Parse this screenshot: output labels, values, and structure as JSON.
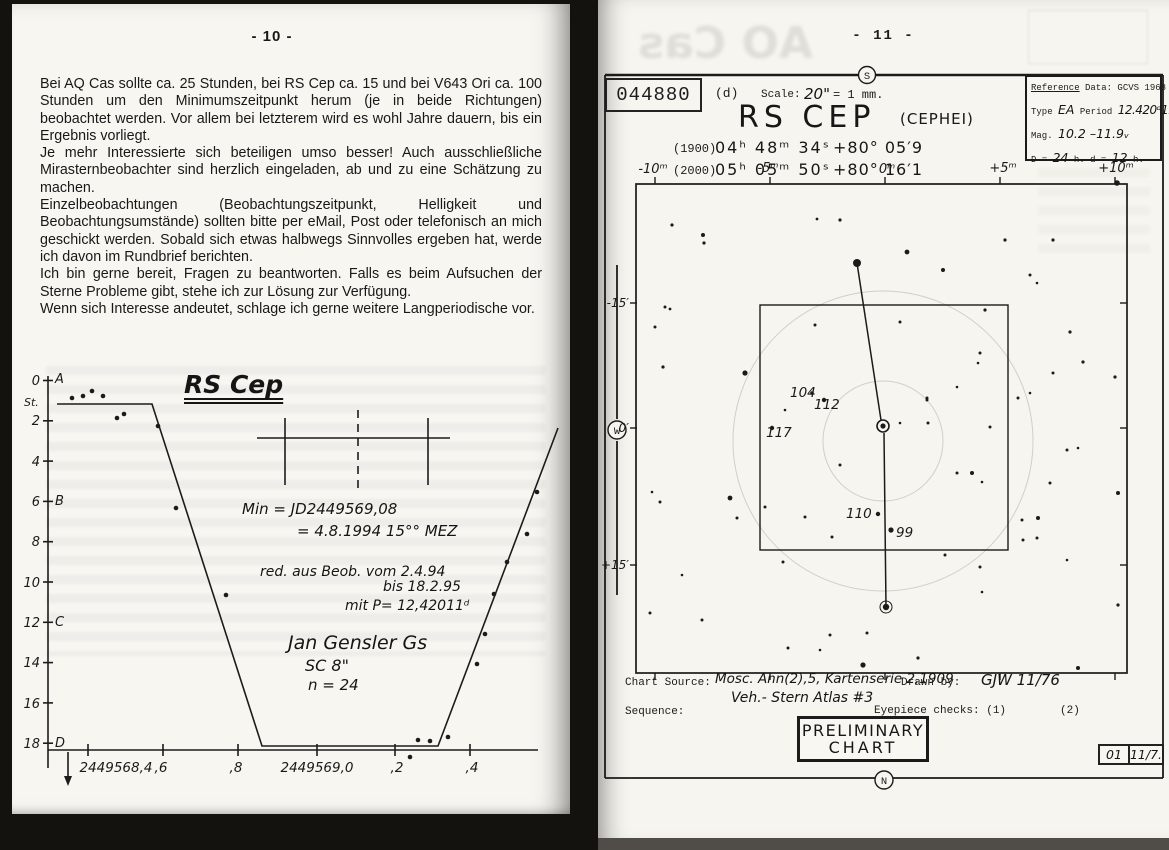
{
  "artifacts": {
    "ghost_text": "AO Cas"
  },
  "left_page": {
    "page_number": "- 10 -",
    "paragraphs": [
      "Bei AQ Cas sollte ca. 25 Stunden, bei RS Cep ca. 15 und bei V643 Ori ca. 100 Stunden um den Minimumszeitpunkt herum (je in beide Richtungen) beobachtet werden. Vor allem bei letzterem wird es wohl Jahre dauern, bis ein Ergebnis vorliegt.",
      "Je mehr Interessierte sich beteiligen umso besser! Auch ausschließliche Mirasternbeobachter sind herzlich eingeladen, ab und zu eine Schätzung zu machen.",
      "Einzelbeobachtungen (Beobachtungszeitpunkt, Helligkeit und Beobachtungsumstände) sollten bitte per eMail, Post oder telefonisch an mich geschickt werden. Sobald sich etwas halbwegs Sinnvolles ergeben hat, werde ich davon im Rundbrief berichten.",
      "Ich bin gerne bereit, Fragen zu beantworten. Falls es beim Aufsuchen der Sterne Probleme gibt, stehe ich zur Lösung zur Verfügung.",
      "Wenn sich Interesse andeutet, schlage ich gerne weitere Langperiodische vor."
    ],
    "light_curve": {
      "title": "RS Cep",
      "ylabel": "St.",
      "y_ticks": [
        "0",
        "2",
        "4",
        "6",
        "8",
        "10",
        "12",
        "14",
        "16",
        "18"
      ],
      "y_letters": [
        "A",
        "B",
        "C",
        "D"
      ],
      "x_ticks": [
        "2449568,4",
        ",6",
        ",8",
        "2449569,0",
        ",2",
        ",4"
      ],
      "scatter_px": [
        [
          50,
          42
        ],
        [
          61,
          40
        ],
        [
          70,
          35
        ],
        [
          81,
          40
        ],
        [
          95,
          62
        ],
        [
          102,
          58
        ],
        [
          136,
          70
        ],
        [
          154,
          152
        ],
        [
          204,
          239
        ],
        [
          388,
          401
        ],
        [
          396,
          384
        ],
        [
          408,
          385
        ],
        [
          426,
          381
        ],
        [
          515,
          136
        ],
        [
          505,
          178
        ],
        [
          485,
          206
        ],
        [
          472,
          238
        ],
        [
          463,
          278
        ],
        [
          455,
          308
        ]
      ]
    },
    "annotations": {
      "min1": "Min = JD2449569,08",
      "min2": "= 4.8.1994  15°° MEZ",
      "red1": "red. aus Beob. vom 2.4.94",
      "red2": "bis 18.2.95",
      "red3": "mit P= 12,42011ᵈ",
      "obs1": "Jan Gensler   Gs",
      "obs2": "SC 8\"",
      "obs3": "n = 24"
    }
  },
  "right_page": {
    "page_number": "- 11 -",
    "header": {
      "chart_id": "044880",
      "band": "(d)",
      "scale_label": "Scale:",
      "scale_value": "20\"",
      "scale_eq": "= 1 mm.",
      "title": "RS  CEP",
      "constellation": "(CEPHEI)",
      "coord_rows": [
        {
          "epoch": "(1900)",
          "ra": "04ʰ 48ᵐ 34ˢ",
          "dec": "+80° 05′9"
        },
        {
          "epoch": "(2000)",
          "ra": "05ʰ 05ᵐ 50ˢ",
          "dec": "+80° 16′1"
        }
      ]
    },
    "reference_box": {
      "title_word": "Reference",
      "title_rest": " Data: GCVS 1968",
      "type_label": "Type",
      "type_value": "EA",
      "period_label": "Period",
      "period_value": "12.420ᵈ11",
      "mag_label": "Mag.",
      "mag_value": "10.2 –11.9ᵥ",
      "d_label": "D =",
      "d_value": "24",
      "d_mid": "h.  d =",
      "d_value2": "12",
      "d_end": "h."
    },
    "compass": {
      "top": "S",
      "left": "W",
      "bottom": "N"
    },
    "star_chart": {
      "x_labels": [
        "-10ᵐ",
        "-5ᵐ",
        "0ᵐ",
        "+5ᵐ",
        "+10ᵐ"
      ],
      "y_labels": [
        "-15′",
        "0′",
        "+15′"
      ],
      "sequence_labels": [
        "104",
        "112",
        "117",
        "110",
        "99"
      ],
      "stars": [
        [
          72,
          169,
          1.6
        ],
        [
          103,
          179,
          2
        ],
        [
          104,
          187,
          1.6
        ],
        [
          240,
          164,
          1.6
        ],
        [
          217,
          163,
          1.4
        ],
        [
          307,
          196,
          2.4
        ],
        [
          343,
          214,
          2
        ],
        [
          405,
          184,
          1.6
        ],
        [
          453,
          184,
          1.6
        ],
        [
          430,
          219,
          1.5
        ],
        [
          437,
          227,
          1.3
        ],
        [
          385,
          254,
          1.6
        ],
        [
          470,
          276,
          1.6
        ],
        [
          65,
          251,
          1.5
        ],
        [
          70,
          253,
          1.4
        ],
        [
          55,
          271,
          1.5
        ],
        [
          63,
          311,
          1.6
        ],
        [
          145,
          317,
          2.6
        ],
        [
          215,
          269,
          1.5
        ],
        [
          300,
          266,
          1.5
        ],
        [
          380,
          297,
          1.5
        ],
        [
          378,
          307,
          1.3
        ],
        [
          483,
          306,
          1.6
        ],
        [
          453,
          317,
          1.5
        ],
        [
          515,
          321,
          1.6
        ],
        [
          430,
          337,
          1.3
        ],
        [
          418,
          342,
          1.5
        ],
        [
          327,
          342,
          1.5
        ],
        [
          357,
          331,
          1.3
        ],
        [
          517,
          127,
          2.8
        ],
        [
          185,
          354,
          1.3
        ],
        [
          327,
          344,
          1.5
        ],
        [
          328,
          367,
          1.5
        ],
        [
          300,
          367,
          1.3
        ],
        [
          390,
          371,
          1.5
        ],
        [
          240,
          409,
          1.5
        ],
        [
          232,
          481,
          1.5
        ],
        [
          52,
          436,
          1.3
        ],
        [
          60,
          446,
          1.5
        ],
        [
          130,
          442,
          2.4
        ],
        [
          137,
          462,
          1.5
        ],
        [
          165,
          451,
          1.5
        ],
        [
          205,
          461,
          1.5
        ],
        [
          357,
          417,
          1.5
        ],
        [
          372,
          417,
          2
        ],
        [
          382,
          426,
          1.3
        ],
        [
          422,
          464,
          1.5
        ],
        [
          438,
          462,
          2
        ],
        [
          450,
          427,
          1.5
        ],
        [
          467,
          394,
          1.5
        ],
        [
          478,
          392,
          1.3
        ],
        [
          518,
          437,
          2
        ],
        [
          183,
          506,
          1.5
        ],
        [
          82,
          519,
          1.3
        ],
        [
          50,
          557,
          1.5
        ],
        [
          102,
          564,
          1.5
        ],
        [
          230,
          579,
          1.5
        ],
        [
          188,
          592,
          1.5
        ],
        [
          220,
          594,
          1.3
        ],
        [
          267,
          577,
          1.5
        ],
        [
          318,
          602,
          1.6
        ],
        [
          263,
          609,
          2.6
        ],
        [
          345,
          499,
          1.5
        ],
        [
          380,
          511,
          1.5
        ],
        [
          382,
          536,
          1.3
        ],
        [
          423,
          484,
          1.5
        ],
        [
          437,
          482,
          1.5
        ],
        [
          518,
          549,
          1.6
        ],
        [
          467,
          504,
          1.3
        ],
        [
          478,
          612,
          2
        ],
        [
          212,
          337,
          1.8
        ],
        [
          224,
          344,
          2.2
        ],
        [
          172,
          372,
          2.2
        ],
        [
          278,
          458,
          2.2
        ],
        [
          291,
          474,
          2.6
        ]
      ]
    },
    "footer": {
      "chart_source_label": "Chart Source:",
      "chart_source_value": "Mosc. Ann(2),5, Kartenserie 2,1909",
      "drawn_by_label": "Drawn by:",
      "drawn_by_value": "GJW   11/76",
      "sequence_label": "Sequence:",
      "sequence_value": "Veh.- Stern  Atlas #3",
      "eyepiece_label": "Eyepiece checks: (1)",
      "eyepiece_2": "(2)",
      "stamp_1": "PRELIMINARY",
      "stamp_2": "CHART",
      "code_1": "01",
      "code_2": "11/7."
    }
  },
  "chart_data": [
    {
      "type": "line",
      "title": "RS Cep — visual light curve around minimum",
      "xlabel": "JD",
      "ylabel": "St.",
      "x_ticks": [
        "2449568,4",
        ",6",
        ",8",
        "2449569,0",
        ",2",
        ",4"
      ],
      "y_ticks": [
        0,
        2,
        4,
        6,
        8,
        10,
        12,
        14,
        16,
        18
      ],
      "ylim": [
        18,
        0
      ],
      "x": [
        2449568.35,
        2449568.59,
        2449568.86,
        2449569.3,
        2449569.61
      ],
      "y": [
        1.2,
        1.2,
        18.1,
        18.1,
        1.3
      ],
      "annotations": [
        "Min = JD2449569,08 = 4.8.1994 15°° MEZ",
        "red. aus Beob. vom 2.4.94 bis 18.2.95 mit P= 12,42011d",
        "Jan Gensler Gs, SC 8\", n = 24"
      ]
    },
    {
      "type": "scatter",
      "title": "RS CEP (CEPHEI) finder chart 044880",
      "sequence": [
        104,
        112,
        117,
        110,
        99
      ],
      "x_axis": [
        "-10m",
        "-5m",
        "0m",
        "+5m",
        "+10m"
      ],
      "y_axis": [
        "-15'",
        "0'",
        "+15'"
      ]
    }
  ]
}
